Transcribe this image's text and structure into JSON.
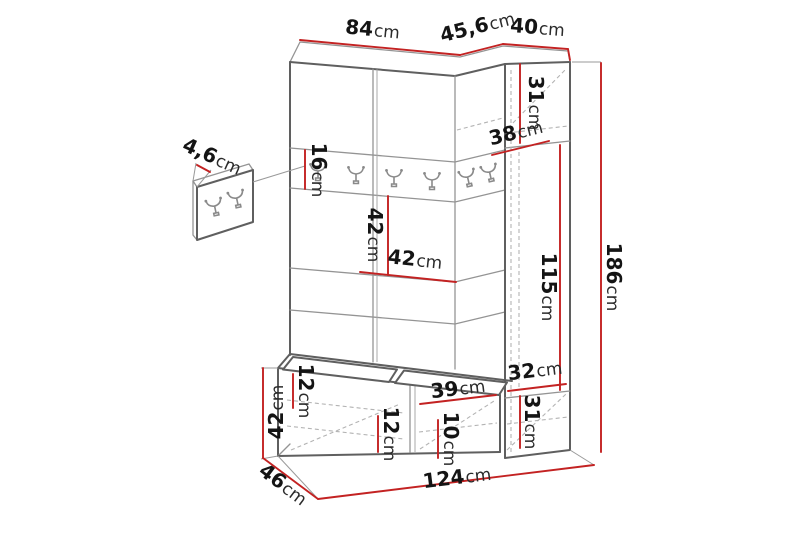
{
  "diagram": {
    "subject": "hallway furniture set dimension drawing",
    "background": "#ffffff",
    "colors": {
      "dimension_line": "#c32222",
      "outline": "#5f5f5f",
      "inner_line": "#949494",
      "hidden_line": "#b3b3b3",
      "text": "#141414"
    },
    "labels": {
      "width_left_section": {
        "value": "84",
        "unit": "cm"
      },
      "width_corner_section": {
        "value": "45,6",
        "unit": "cm"
      },
      "width_right_section": {
        "value": "40",
        "unit": "cm"
      },
      "height_top_right_door": {
        "value": "31",
        "unit": "cm"
      },
      "depth_corner": {
        "value": "38",
        "unit": "cm"
      },
      "height_rack_panel": {
        "value": "16",
        "unit": "cm"
      },
      "thickness_hook_panel": {
        "value": "4,6",
        "unit": "cm"
      },
      "height_mid_gap": {
        "value": "42",
        "unit": "cm"
      },
      "width_mid_gap": {
        "value": "42",
        "unit": "cm"
      },
      "height_tall_door": {
        "value": "115",
        "unit": "cm"
      },
      "height_total": {
        "value": "186",
        "unit": "cm"
      },
      "height_bench": {
        "value": "42",
        "unit": "cm"
      },
      "depth_bench": {
        "value": "46",
        "unit": "cm"
      },
      "shelf_gap_top": {
        "value": "12",
        "unit": "cm"
      },
      "shelf_gap_left": {
        "value": "12",
        "unit": "cm"
      },
      "width_bench_door": {
        "value": "39",
        "unit": "cm"
      },
      "shelf_gap_right": {
        "value": "10",
        "unit": "cm"
      },
      "height_base_top": {
        "value": "32",
        "unit": "cm"
      },
      "height_base_door": {
        "value": "31",
        "unit": "cm"
      },
      "width_total": {
        "value": "124",
        "unit": "cm"
      }
    }
  }
}
